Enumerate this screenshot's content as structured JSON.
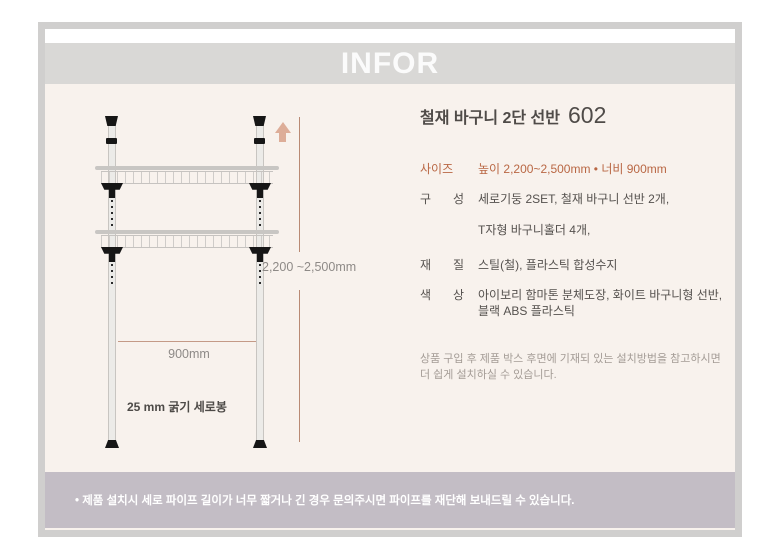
{
  "header": {
    "title": "INFOR"
  },
  "product": {
    "title": "철재 바구니 2단 선반",
    "model": "602",
    "specs": [
      {
        "label": "사이즈",
        "lines": [
          "높이 2,200~2,500mm • 너비 900mm"
        ]
      },
      {
        "label": "구 성",
        "lines": [
          "세로기둥 2SET, 철재 바구니 선반 2개,",
          "T자형 바구니홀더 4개,"
        ]
      },
      {
        "label": "재 질",
        "lines": [
          "스틸(철), 플라스틱 합성수지"
        ]
      },
      {
        "label": "색 상",
        "lines": [
          "아이보리 함마톤 분체도장, 화이트 바구니형 선반,",
          "블랙 ABS 플라스틱"
        ]
      }
    ],
    "note_lines": [
      "상품 구입 후 제품 박스 후면에 기재되 있는 설치방법을 참고하시면",
      "더 쉽게 설치하실 수 있습니다."
    ]
  },
  "diagram": {
    "height_label": "2,200 ~2,500mm",
    "width_label": "900mm",
    "pole_label": "25 mm 굵기 세로봉"
  },
  "footer": {
    "notice": "• 제품 설치시 세로 파이프 길이가 너무 짧거나 긴 경우 문의주시면 파이프를 재단해 보내드릴 수 있습니다."
  },
  "colors": {
    "accent_terracotta": "#b96744",
    "dimension_line": "#b98a74",
    "arrow_salmon": "#ddad98",
    "footer_bar": "#c3bdc5",
    "header_band": "#d9d8d6",
    "background_cream": "#f8f2ed"
  }
}
